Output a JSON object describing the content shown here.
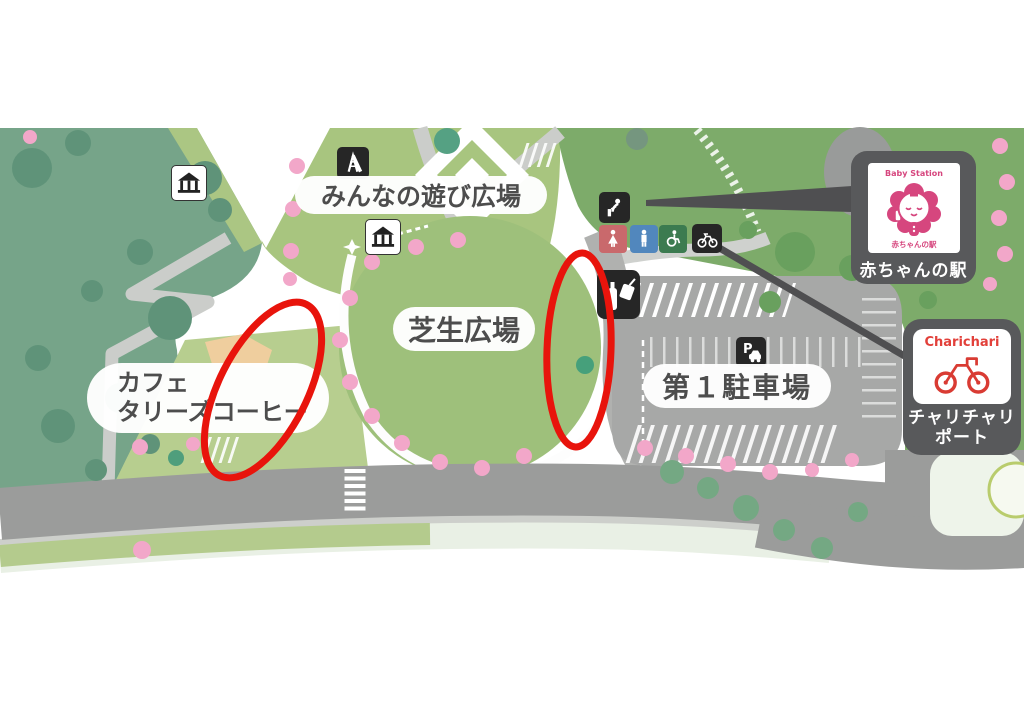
{
  "labels": {
    "play_plaza": "みんなの遊び広場",
    "lawn_plaza": "芝生広場",
    "cafe_line1": "カフェ",
    "cafe_line2": "タリーズコーヒー",
    "parking_lot": "第１駐車場"
  },
  "badges": {
    "baby_station": {
      "logo_text_top": "Baby Station",
      "logo_text_bottom": "赤ちゃんの駅",
      "label": "赤ちゃんの駅"
    },
    "charichari": {
      "brand": "Charichari",
      "label_line1": "チャリチャリ",
      "label_line2": "ポート"
    }
  },
  "icons": {
    "playground-slide-icon": "slide",
    "gazebo-icon-upper": "gazebo",
    "gazebo-icon-lower": "gazebo",
    "drinking-fountain-icon": "drinking fountain",
    "toilet-women-icon": "women toilet",
    "toilet-men-icon": "men toilet",
    "accessible-toilet-icon": "wheelchair accessible toilet",
    "bicycle-parking-icon": "bicycle parking",
    "vending-machine-icon": "vending machine",
    "parking-icon": "car parking",
    "parking_icon_letter": "P"
  },
  "annotations": {
    "highlight_color": "#e8140c",
    "ellipses": [
      {
        "cx": 263,
        "cy": 390,
        "rx": 44,
        "ry": 96,
        "rotate": 27
      },
      {
        "cx": 579,
        "cy": 350,
        "rx": 32,
        "ry": 97,
        "rotate": 2
      }
    ]
  },
  "colors": {
    "badge_background": "#58595b",
    "baby_station_pink": "#d6467e",
    "charichari_red": "#e2403a",
    "toilet_women_red": "#c9696c",
    "toilet_men_blue": "#5187bd",
    "accessible_green": "#3c7b50",
    "park_green_dark": "#76a489",
    "park_green_light": "#a8c57f",
    "lawn_green": "#9ec07b",
    "sakura_pink": "#f2a7c9",
    "road_gray": "#9b9c9b"
  }
}
